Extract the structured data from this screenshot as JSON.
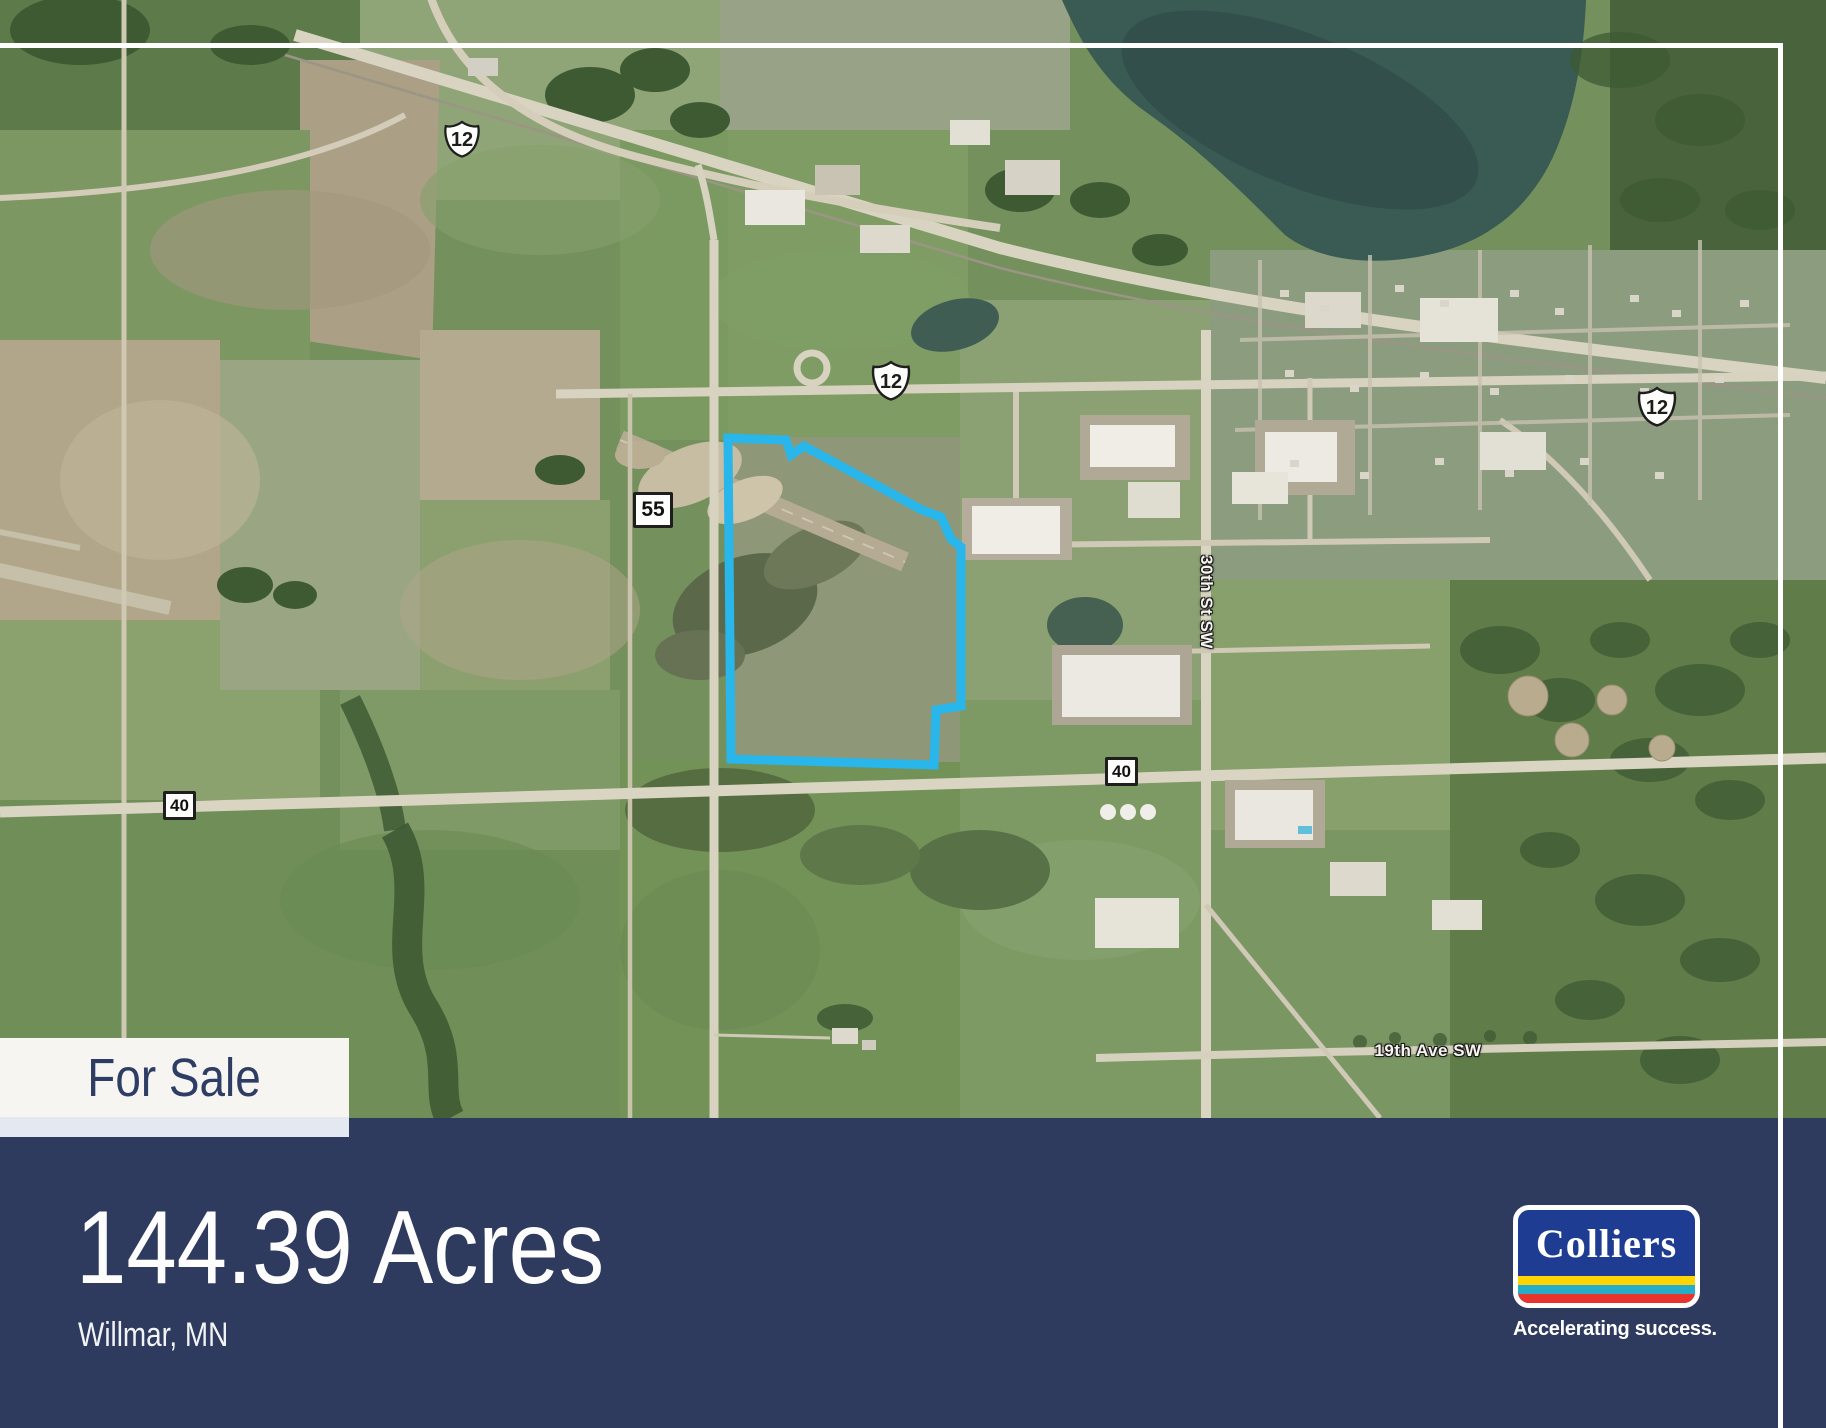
{
  "flyer": {
    "for_sale_label": "For Sale",
    "acreage": "144.39 Acres",
    "location": "Willmar, MN"
  },
  "branding": {
    "logo_text": "Colliers",
    "tagline": "Accelerating success."
  },
  "map": {
    "route_shields": {
      "us12_northwest": "12",
      "us12_central": "12",
      "us12_east": "12",
      "route_55": "55",
      "route_40_west": "40",
      "route_40_east": "40"
    },
    "street_labels": {
      "street_30th": "30th St SW",
      "avenue_19th": "19th Ave SW"
    }
  },
  "colors": {
    "property_outline": "#29b6ea",
    "banner_navy": "#2e3a5e",
    "for_sale_box": "#f6f5f2",
    "accent_stripe": "#e4e8f1",
    "logo_blue": "#1e3c91",
    "logo_yellow": "#ffd402",
    "logo_teal": "#26aec9",
    "logo_red": "#e8342c"
  }
}
